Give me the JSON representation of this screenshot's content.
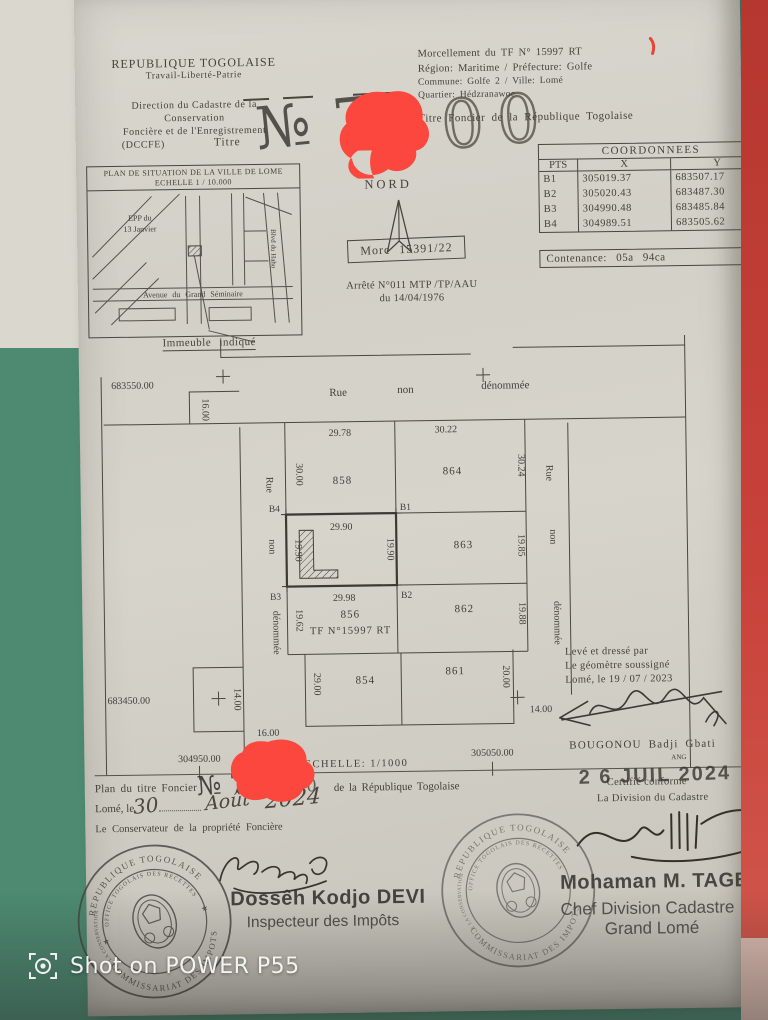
{
  "photo": {
    "watermark_text": "Shot on POWER P55"
  },
  "header_left": {
    "country": "REPUBLIQUE TOGOLAISE",
    "motto": "Travail-Liberté-Patrie",
    "dept1": "Direction du Cadastre de la",
    "dept2": "Conservation",
    "dept3": "Foncière et de l'Enregistrement",
    "dept4": "(DCCFE)",
    "titre_label": "Titre"
  },
  "title_number": {
    "prefix": "№ 7",
    "masked_suffix": "00"
  },
  "header_right": {
    "line1": "Morcellement du TF  N° 15997 RT",
    "line2": "Région: Maritime / Préfecture: Golfe",
    "line3": "Commune: Golfe 2 / Ville: Lomé",
    "line4": "Quartier: Hédzranawoe",
    "line5": "Titre Foncier de la République Togolaise"
  },
  "coordinates": {
    "title": "COORDONNEES",
    "col_pts": "PTS",
    "col_x": "X",
    "col_y": "Y",
    "rows": [
      {
        "pt": "B1",
        "x": "305019.37",
        "y": "683507.17"
      },
      {
        "pt": "B2",
        "x": "305020.43",
        "y": "683487.30"
      },
      {
        "pt": "B3",
        "x": "304990.48",
        "y": "683485.84"
      },
      {
        "pt": "B4",
        "x": "304989.51",
        "y": "683505.62"
      }
    ],
    "contenance": "Contenance:  05a  94ca"
  },
  "situation_map": {
    "title1": "PLAN DE SITUATION DE LA VILLE DE LOME",
    "title2": "ECHELLE 1 / 10.000",
    "epp1": "EPP du",
    "epp2": "13 Janvier",
    "avenue": "Avenue du Grand  Séminaire",
    "blvd": "Blvd du Haho",
    "caption": "Immeuble indiqué"
  },
  "north_label": "NORD",
  "morc_label": "Morc 15391/22",
  "arrete": {
    "line1": "Arrêté N°011 MTP /TP/AAU",
    "line2": "du 14/04/1976"
  },
  "plan": {
    "grid_nw": "683550.00",
    "grid_sw": "683450.00",
    "grid_s_left": "304950.00",
    "grid_s_right": "305050.00",
    "scale": "ECHELLE:  1/1000",
    "corner_note": "ANG",
    "street_words": [
      "Rue",
      "non",
      "dénommée"
    ],
    "corners": {
      "b1": "B1",
      "b2": "B2",
      "b3": "B3",
      "b4": "B4"
    },
    "subject": {
      "tf": "TF  N°15997  RT",
      "dim_top": "29.90",
      "dim_bottom": "29.98",
      "dim_left": "19.90",
      "dim_right": "19.90"
    },
    "parcels": {
      "p858": "858",
      "p864": "864",
      "p863": "863",
      "p862": "862",
      "p856": "856",
      "p854": "854",
      "p861": "861"
    },
    "dims": {
      "d2978": "29.78",
      "d3022": "30.22",
      "d3000": "30.00",
      "d3024": "30.24",
      "d1985": "19.85",
      "d1988": "19.88",
      "d1962": "19.62",
      "d2900": "29.00",
      "d2000": "20.00",
      "d1600t": "16.00",
      "d1400l": "14.00",
      "d1600b": "16.00",
      "d1400r": "14.00"
    }
  },
  "surveyor": {
    "line1": "Levé et dressé par",
    "line2": "Le géomètre soussigné",
    "line3": "Lomé, le 19 / 07 / 2023",
    "name": "BOUGONOU Badji Gbati"
  },
  "footer": {
    "plan_prefix": "Plan du titre Foncier",
    "plan_no": "№ 7",
    "masked_digit": "0",
    "plan_suffix": "de la République Togolaise",
    "city_label": "Lomé, le",
    "hand_day": "30",
    "hand_month": "Août",
    "hand_year": "2024",
    "conservateur": "Le  Conservateur de la propriété Foncière",
    "certifie": "Certifié conforme",
    "date_stamp": "2 6 JUIL 2024",
    "division": "La Division du Cadastre"
  },
  "signatories": {
    "left_name": "Dossêh Kodjo DEVI",
    "left_title": "Inspecteur des Impôts",
    "right_name": "Mohaman M. TAGBA",
    "right_title1": "Chef Division Cadastre",
    "right_title2": "Grand Lomé"
  },
  "stamp": {
    "ring_top": "REPUBLIQUE TOGOLAISE",
    "ring_inner_top": "OFFICE TOGOLAIS DES RECETTES",
    "ring_bottom": "COMMISSARIAT DES IMPOTS",
    "ring_left": "DIVISION DE LA CONSERVATION FONCIERE"
  },
  "colors": {
    "cloth_green": "#4f8b73",
    "paper": "#d6d3ca",
    "red_strip": "#c23a31",
    "marker_red": "#fb473d",
    "ink": "#46413b"
  }
}
